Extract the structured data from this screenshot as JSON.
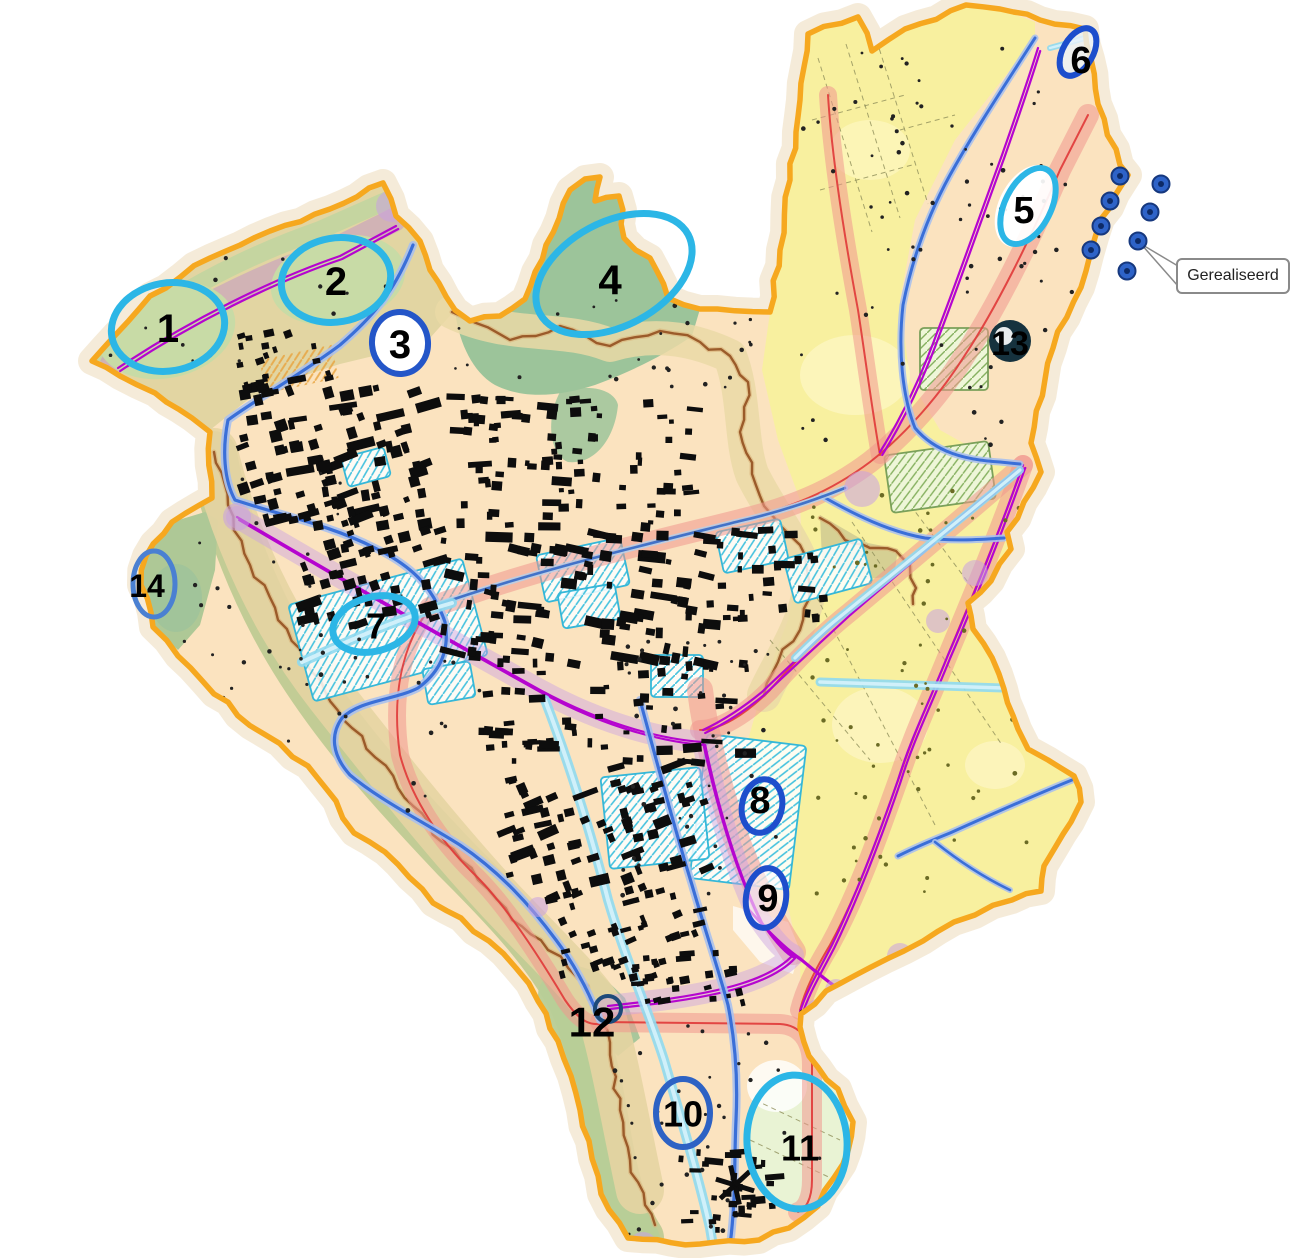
{
  "map": {
    "callout": {
      "label": "Gerealiseerd"
    },
    "markers": [
      {
        "label": "1",
        "kind": "ellipse",
        "cx": 168,
        "cy": 327,
        "rx": 57,
        "ry": 44,
        "rot": -10,
        "stroke": "#2cb6e6",
        "sw": 7,
        "fill": "none",
        "lx": 168,
        "ly": 329,
        "fs": 40
      },
      {
        "label": "2",
        "kind": "ellipse",
        "cx": 336,
        "cy": 280,
        "rx": 55,
        "ry": 42,
        "rot": -10,
        "stroke": "#2cb6e6",
        "sw": 7,
        "fill": "none",
        "lx": 336,
        "ly": 282,
        "fs": 40
      },
      {
        "label": "3",
        "kind": "ellipse",
        "cx": 400,
        "cy": 343,
        "rx": 28,
        "ry": 31,
        "rot": -5,
        "stroke": "#2456c8",
        "sw": 6,
        "fill": "#ffffff",
        "lx": 400,
        "ly": 345,
        "fs": 40
      },
      {
        "label": "4",
        "kind": "ellipse",
        "cx": 614,
        "cy": 274,
        "rx": 84,
        "ry": 52,
        "rot": -28,
        "stroke": "#2cb6e6",
        "sw": 7,
        "fill": "none",
        "lx": 610,
        "ly": 280,
        "fs": 42
      },
      {
        "label": "5",
        "kind": "ellipse",
        "cx": 1028,
        "cy": 206,
        "rx": 23,
        "ry": 41,
        "rot": 27,
        "stroke": "#2cb6e6",
        "sw": 6,
        "fill": "rgba(255,255,255,0.92)",
        "lx": 1024,
        "ly": 211,
        "fs": 38
      },
      {
        "label": "6",
        "kind": "ellipse",
        "cx": 1078,
        "cy": 52,
        "rx": 15,
        "ry": 26,
        "rot": 30,
        "stroke": "#1d4ecc",
        "sw": 6,
        "fill": "rgba(235,243,250,0.8)",
        "lx": 1081,
        "ly": 61,
        "fs": 38
      },
      {
        "label": "7",
        "kind": "ellipse",
        "cx": 374,
        "cy": 624,
        "rx": 42,
        "ry": 27,
        "rot": -15,
        "stroke": "#2cb6e6",
        "sw": 7,
        "fill": "none",
        "lx": 376,
        "ly": 626,
        "fs": 36
      },
      {
        "label": "8",
        "kind": "ellipse",
        "cx": 762,
        "cy": 806,
        "rx": 20,
        "ry": 27,
        "rot": 12,
        "stroke": "#1e4ecc",
        "sw": 6,
        "fill": "none",
        "lx": 760,
        "ly": 801,
        "fs": 38
      },
      {
        "label": "9",
        "kind": "ellipse",
        "cx": 766,
        "cy": 898,
        "rx": 20,
        "ry": 30,
        "rot": 8,
        "stroke": "#1e4ecc",
        "sw": 6,
        "fill": "rgba(255,255,255,0.55)",
        "lx": 768,
        "ly": 899,
        "fs": 38
      },
      {
        "label": "10",
        "kind": "ellipse",
        "cx": 683,
        "cy": 1113,
        "rx": 27,
        "ry": 34,
        "rot": 0,
        "stroke": "#2d62c4",
        "sw": 6,
        "fill": "none",
        "lx": 683,
        "ly": 1114,
        "fs": 36
      },
      {
        "label": "11",
        "kind": "ellipse",
        "cx": 797,
        "cy": 1142,
        "rx": 50,
        "ry": 67,
        "rot": -4,
        "stroke": "#2cb6e6",
        "sw": 7,
        "fill": "none",
        "lx": 800,
        "ly": 1148,
        "fs": 36
      },
      {
        "label": "12",
        "kind": "circle-label",
        "cx": 608,
        "cy": 1009,
        "r": 13,
        "stroke": "#1d4a7a",
        "sw": 4,
        "fill": "none",
        "lx": 592,
        "ly": 1022,
        "fs": 42
      },
      {
        "label": "13",
        "kind": "disc",
        "cx": 1010,
        "cy": 341,
        "r": 21,
        "fill": "#16323e",
        "lx": 1010,
        "ly": 344,
        "fs": 34
      },
      {
        "label": "14",
        "kind": "ellipse",
        "cx": 154,
        "cy": 584,
        "rx": 21,
        "ry": 33,
        "rot": 0,
        "stroke": "#4a80d2",
        "sw": 5,
        "fill": "none",
        "lx": 147,
        "ly": 586,
        "fs": 32
      }
    ],
    "realized_dots": [
      [
        1120,
        176
      ],
      [
        1161,
        184
      ],
      [
        1110,
        201
      ],
      [
        1150,
        212
      ],
      [
        1101,
        226
      ],
      [
        1138,
        241
      ],
      [
        1091,
        250
      ],
      [
        1127,
        271
      ]
    ],
    "palette": {
      "boundary": "#f6a81f",
      "base": "#fbe3bf",
      "yellow": "#f8f09f",
      "green_dark": "#9cc49a",
      "green_light": "#c8dba6",
      "olive_band": "#bfca92",
      "corridor_pink": "#f0988e",
      "corridor_red": "#e03838",
      "rail_magenta": "#b505cf",
      "rail_buffer": "#c9a0e2",
      "road_blue": "#3a6fd8",
      "road_cyan": "#8fd9ef",
      "contour_brown": "#9b5b2a",
      "building": "#0d0d0d",
      "realized_dot": "#2e63c8"
    }
  }
}
